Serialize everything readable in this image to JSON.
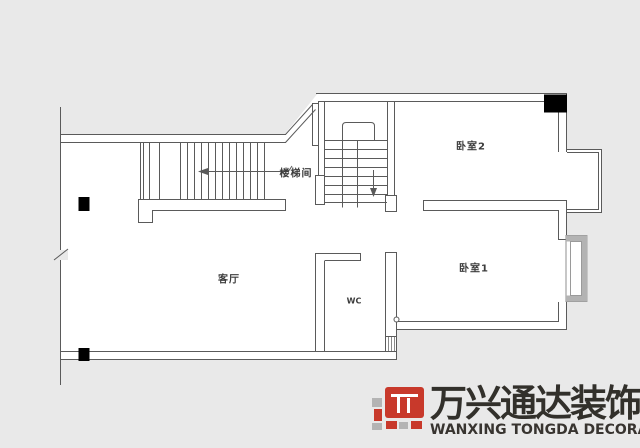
{
  "canvas": {
    "width": 640,
    "height": 448,
    "background": "#e9e9e9"
  },
  "plan": {
    "type": "apartment-floor-plan",
    "line_color": "#5a5a5a",
    "floor_color": "#ffffff",
    "column_color": "#000000",
    "window_frame_color": "#b3b3b3",
    "rooms": [
      {
        "name": "living-room",
        "label": "客厅"
      },
      {
        "name": "stair-hall",
        "label": "楼梯间"
      },
      {
        "name": "bedroom-2",
        "label": "卧室2"
      },
      {
        "name": "bedroom-1",
        "label": "卧室1"
      },
      {
        "name": "wc",
        "label": "WC"
      }
    ],
    "symbols": [
      "structural-column-black-squares",
      "stair-direction-arrows",
      "bay-windows",
      "wall-break-mark"
    ]
  },
  "logo": {
    "chinese": "万兴通达装饰",
    "english": "WANXING TONGDA DECORATION",
    "red": "#c8392b",
    "block_gray": "#b4b4b4",
    "text_color": "#32302b"
  }
}
